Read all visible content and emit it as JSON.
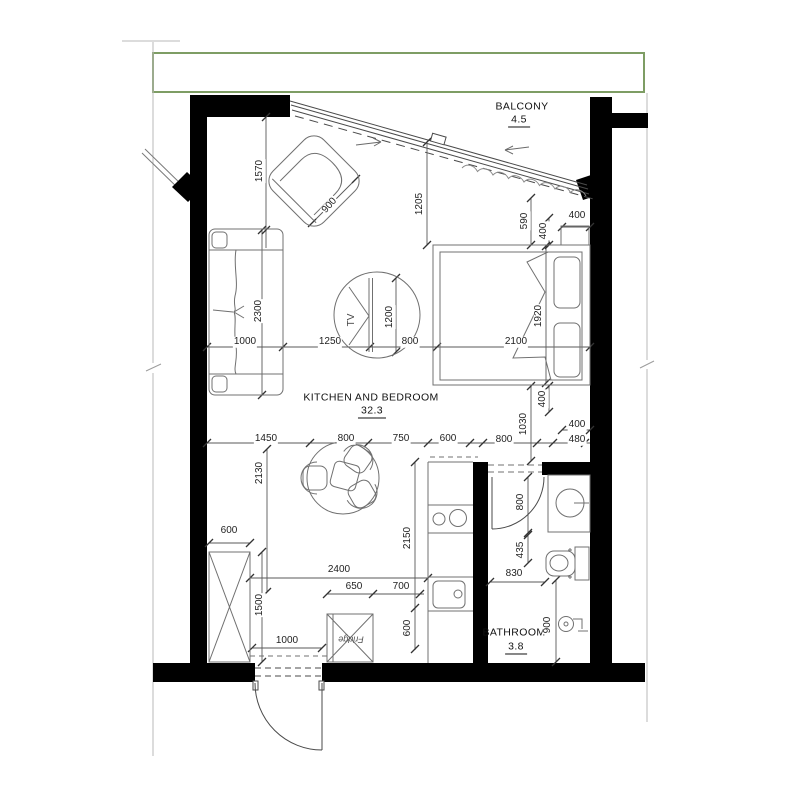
{
  "plan_title": "apartment-floor-plan",
  "rooms": {
    "balcony": {
      "name": "BALCONY",
      "area": "4.5"
    },
    "kitchen_bedroom": {
      "name": "KITCHEN AND BEDROOM",
      "area": "32.3"
    },
    "bathroom": {
      "name": "BATHROOM",
      "area": "3.8"
    }
  },
  "furniture": {
    "tv": "TV",
    "fridge": "Fridge"
  },
  "dims": {
    "d1000a": "1000",
    "d1250": "1250",
    "d800c": "800",
    "d2100": "2100",
    "d1450": "1450",
    "d800a": "800",
    "d750": "750",
    "d600a": "600",
    "d800b": "800",
    "d480": "480",
    "d1570": "1570",
    "d900a": "900",
    "d1205": "1205",
    "d590": "590",
    "d400a": "400",
    "d400c": "400",
    "d2300": "2300",
    "d1200": "1200",
    "d1920": "1920",
    "d400b": "400",
    "d1030": "1030",
    "d400d": "400",
    "d2130": "2130",
    "d600w": "600",
    "d1500": "1500",
    "d2400": "2400",
    "d650": "650",
    "d700": "700",
    "d1000b": "1000",
    "d2150": "2150",
    "d600b": "600",
    "d800e": "800",
    "d435": "435",
    "d830": "830",
    "d900b": "900"
  },
  "colors": {
    "wall": "#000000",
    "green_outline": "#7e9d64",
    "drawing_line": "#4a4a4a",
    "furniture_line": "#707070"
  }
}
